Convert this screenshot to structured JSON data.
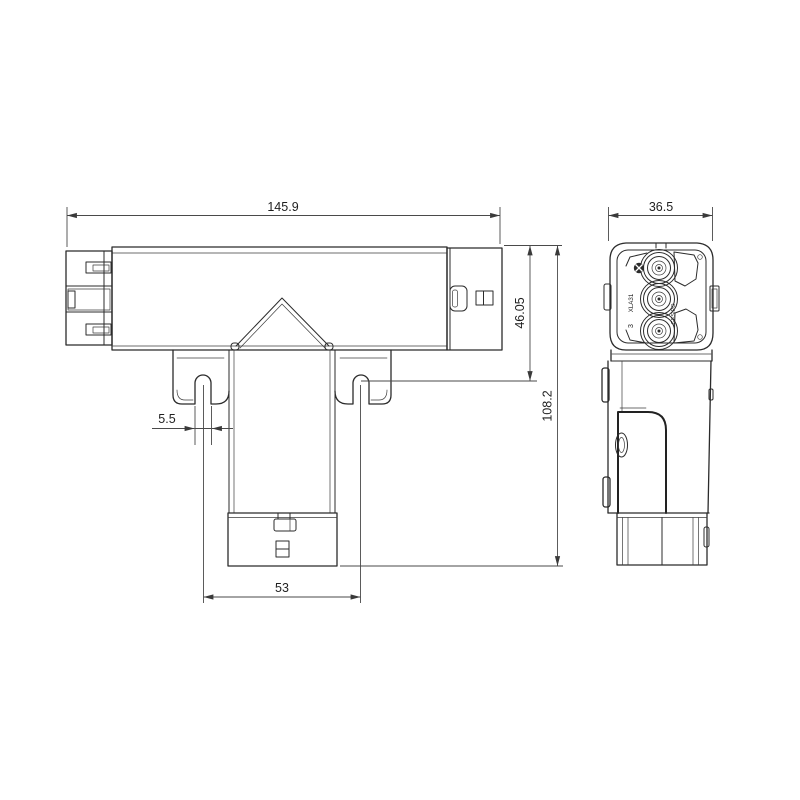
{
  "drawing": {
    "background_color": "#ffffff",
    "line_color": "#2b2b2b",
    "dimension_color": "#4a4a4a",
    "dimensions": {
      "overall_width": "145.9",
      "side_width": "36.5",
      "upper_body_height": "46.05",
      "overall_height": "108.2",
      "slot_width": "5.5",
      "hook_spacing": "53"
    },
    "face_markings": {
      "left_code": "XLA31",
      "left_number": "3",
      "right_code": "GESIPO"
    }
  }
}
